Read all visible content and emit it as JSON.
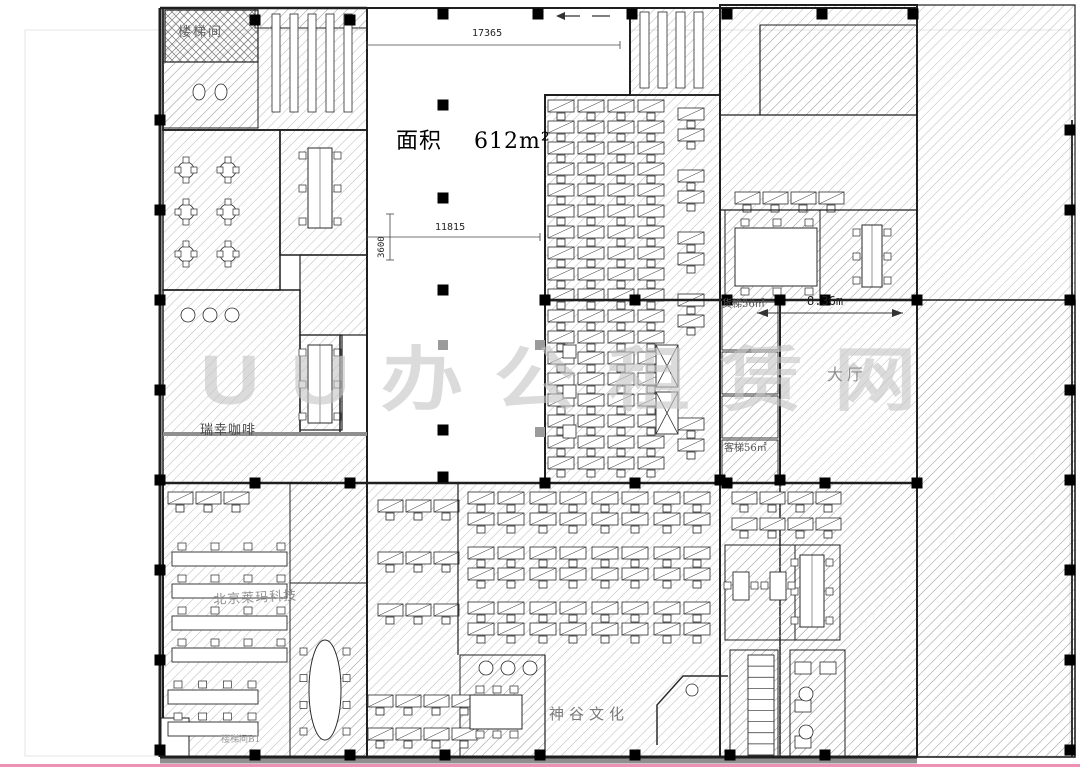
{
  "page": {
    "bg": "#ffffff",
    "frame_color": "#e4e4e4",
    "bottom_line_color": "#ee91b4"
  },
  "plan": {
    "labels": {
      "area": {
        "text": "面积    612m²"
      },
      "stair_tl": {
        "text": "楼梯间"
      },
      "luckin": {
        "text": "瑞幸咖啡"
      },
      "company": {
        "text": "北京莱玛科技"
      },
      "stair_b1": {
        "text": "楼梯间B1"
      },
      "shengu": {
        "text": "神谷文化"
      },
      "lobby": {
        "text": "大厅"
      },
      "freight": {
        "text": "货梯56㎡"
      },
      "passenger": {
        "text": "客梯56㎡"
      }
    },
    "dims": {
      "top": {
        "text": "17365"
      },
      "mid": {
        "text": "11815"
      },
      "left": {
        "text": "3600"
      },
      "lobby_width": {
        "text": "8.36m"
      }
    },
    "watermark": {
      "text": "UU办公租赁网"
    },
    "colors": {
      "hatch": "#9a9a9a",
      "wall": "#1f1f1f",
      "gray_wall": "#8f8f8f",
      "furniture": "#2a2a2a"
    },
    "geometry": {
      "rooms": [
        [
          255,
          8,
          112,
          20,
          "h",
          1
        ],
        [
          163,
          8,
          204,
          122,
          "h",
          1.8
        ],
        [
          165,
          10,
          93,
          52,
          "x",
          1.2
        ],
        [
          163,
          62,
          95,
          66,
          "h",
          1
        ],
        [
          163,
          130,
          117,
          160,
          "h",
          1.5
        ],
        [
          280,
          130,
          87,
          125,
          "h",
          1.5
        ],
        [
          163,
          290,
          137,
          143,
          "h",
          1.5
        ],
        [
          300,
          255,
          67,
          80,
          "h",
          1.2
        ],
        [
          300,
          335,
          42,
          95,
          "h",
          1.2
        ],
        [
          163,
          433,
          204,
          50,
          "h",
          1.5
        ],
        [
          163,
          483,
          204,
          274,
          "h",
          2
        ],
        [
          290,
          483,
          77,
          100,
          "h",
          1
        ],
        [
          290,
          583,
          77,
          174,
          "h",
          1
        ],
        [
          630,
          8,
          90,
          87,
          "h",
          1.5
        ],
        [
          545,
          95,
          175,
          388,
          "h",
          1.8
        ],
        [
          720,
          5,
          197,
          295,
          "h",
          2
        ],
        [
          760,
          25,
          157,
          90,
          "h",
          1
        ],
        [
          725,
          210,
          95,
          90,
          "h",
          1
        ],
        [
          820,
          210,
          97,
          90,
          "h",
          1
        ],
        [
          917,
          5,
          158,
          752,
          "h",
          1.2
        ],
        [
          780,
          300,
          295,
          457,
          "h",
          1.5
        ],
        [
          720,
          300,
          60,
          183,
          "h",
          1.5
        ],
        [
          722,
          302,
          56,
          48,
          "h",
          0.9
        ],
        [
          722,
          352,
          56,
          42,
          "h",
          0.9
        ],
        [
          722,
          396,
          56,
          42,
          "h",
          0.9
        ],
        [
          722,
          440,
          56,
          43,
          "h",
          0.9
        ],
        [
          367,
          483,
          353,
          274,
          "h",
          1.8
        ],
        [
          720,
          483,
          197,
          274,
          "h",
          1.8
        ],
        [
          460,
          655,
          85,
          102,
          "h",
          1
        ],
        [
          725,
          545,
          70,
          95,
          "h",
          1
        ],
        [
          795,
          545,
          45,
          95,
          "h",
          1
        ],
        [
          730,
          650,
          48,
          107,
          "h",
          1
        ],
        [
          790,
          650,
          55,
          107,
          "h",
          1
        ],
        [
          161,
          718,
          28,
          39,
          "w",
          1
        ]
      ],
      "atrium_path": "M367,8 L630,8 L630,95 L545,95 L545,483 L367,483 Z",
      "walls": [
        [
          160,
          8,
          160,
          757,
          3
        ],
        [
          160,
          757,
          917,
          757,
          3
        ],
        [
          160,
          8,
          367,
          8,
          2.5
        ],
        [
          630,
          8,
          917,
          8,
          2
        ],
        [
          545,
          300,
          917,
          300,
          2.5
        ],
        [
          160,
          483,
          917,
          483,
          2.5
        ],
        [
          720,
          5,
          720,
          300,
          2
        ],
        [
          720,
          300,
          720,
          483,
          2
        ],
        [
          780,
          300,
          780,
          483,
          2
        ],
        [
          760,
          25,
          760,
          115,
          1.2
        ],
        [
          720,
          115,
          917,
          115,
          1.2
        ],
        [
          720,
          210,
          917,
          210,
          1.2
        ],
        [
          917,
          5,
          917,
          757,
          2
        ],
        [
          1072,
          120,
          1072,
          757,
          1.8
        ],
        [
          458,
          483,
          458,
          655,
          1.2
        ],
        [
          545,
          655,
          545,
          757,
          1.2
        ],
        [
          340,
          335,
          340,
          433,
          1.5
        ]
      ],
      "gray_walls": [
        [
          160,
          761,
          917,
          761,
          5
        ],
        [
          163,
          434,
          367,
          434,
          4
        ]
      ],
      "columns": [
        [
          443,
          14
        ],
        [
          538,
          14
        ],
        [
          632,
          14
        ],
        [
          727,
          14
        ],
        [
          822,
          14
        ],
        [
          913,
          14
        ],
        [
          255,
          20
        ],
        [
          350,
          20
        ],
        [
          443,
          105
        ],
        [
          443,
          198
        ],
        [
          443,
          290
        ],
        [
          443,
          430
        ],
        [
          443,
          477
        ],
        [
          160,
          120
        ],
        [
          160,
          210
        ],
        [
          160,
          300
        ],
        [
          160,
          390
        ],
        [
          160,
          480
        ],
        [
          160,
          570
        ],
        [
          160,
          660
        ],
        [
          160,
          750
        ],
        [
          545,
          300
        ],
        [
          635,
          300
        ],
        [
          727,
          300
        ],
        [
          780,
          300
        ],
        [
          825,
          300
        ],
        [
          917,
          300
        ],
        [
          255,
          483
        ],
        [
          350,
          483
        ],
        [
          545,
          483
        ],
        [
          635,
          483
        ],
        [
          727,
          483
        ],
        [
          825,
          483
        ],
        [
          917,
          483
        ],
        [
          255,
          755
        ],
        [
          350,
          755
        ],
        [
          445,
          755
        ],
        [
          540,
          755
        ],
        [
          635,
          755
        ],
        [
          730,
          755
        ],
        [
          825,
          755
        ],
        [
          1070,
          130
        ],
        [
          1070,
          210
        ],
        [
          1070,
          300
        ],
        [
          1070,
          390
        ],
        [
          1070,
          480
        ],
        [
          1070,
          570
        ],
        [
          1070,
          660
        ],
        [
          1070,
          750
        ],
        [
          720,
          480
        ],
        [
          780,
          480
        ]
      ],
      "gray_columns": [
        [
          443,
          345
        ],
        [
          540,
          345
        ],
        [
          540,
          432
        ]
      ],
      "pods3": [
        [
          548,
          100
        ],
        [
          608,
          100
        ],
        [
          548,
          163
        ],
        [
          608,
          163
        ],
        [
          548,
          226
        ],
        [
          608,
          226
        ],
        [
          548,
          289
        ],
        [
          608,
          289
        ],
        [
          548,
          352
        ],
        [
          608,
          352
        ],
        [
          548,
          415
        ],
        [
          608,
          415
        ]
      ],
      "pods2": [
        [
          468,
          492
        ],
        [
          530,
          492
        ],
        [
          592,
          492
        ],
        [
          654,
          492
        ],
        [
          468,
          547
        ],
        [
          530,
          547
        ],
        [
          592,
          547
        ],
        [
          654,
          547
        ],
        [
          468,
          602
        ],
        [
          530,
          602
        ],
        [
          592,
          602
        ],
        [
          654,
          602
        ]
      ],
      "pods1": [
        [
          678,
          108
        ],
        [
          678,
          170
        ],
        [
          678,
          232
        ],
        [
          678,
          294
        ],
        [
          678,
          418
        ]
      ],
      "rowdesks": [
        [
          378,
          500,
          3
        ],
        [
          378,
          552,
          3
        ],
        [
          378,
          604,
          3
        ],
        [
          368,
          695,
          4
        ],
        [
          368,
          728,
          4
        ],
        [
          732,
          492,
          4
        ],
        [
          732,
          518,
          4
        ],
        [
          168,
          492,
          3
        ],
        [
          735,
          192,
          4
        ]
      ],
      "roundtables": [
        [
          186,
          170
        ],
        [
          228,
          170
        ],
        [
          186,
          212
        ],
        [
          228,
          212
        ],
        [
          186,
          254
        ],
        [
          228,
          254
        ]
      ],
      "vbars": [
        [
          272,
          14,
          8,
          98
        ],
        [
          290,
          14,
          8,
          98
        ],
        [
          308,
          14,
          8,
          98
        ],
        [
          326,
          14,
          8,
          98
        ],
        [
          344,
          14,
          8,
          98
        ],
        [
          640,
          12,
          9,
          76
        ],
        [
          658,
          12,
          9,
          76
        ],
        [
          676,
          12,
          9,
          76
        ],
        [
          694,
          12,
          9,
          76
        ]
      ],
      "vbenches": [
        [
          308,
          148,
          24,
          80
        ],
        [
          308,
          345,
          24,
          78
        ],
        [
          862,
          225,
          20,
          62
        ],
        [
          800,
          555,
          24,
          72
        ]
      ],
      "hbenches": [
        [
          172,
          552,
          115,
          14
        ],
        [
          172,
          584,
          115,
          14
        ],
        [
          172,
          616,
          115,
          14
        ],
        [
          172,
          648,
          115,
          14
        ],
        [
          168,
          690,
          90,
          14
        ],
        [
          168,
          722,
          90,
          14
        ]
      ],
      "ctables": [
        [
          735,
          228,
          82,
          58
        ],
        [
          470,
          695,
          52,
          34
        ]
      ],
      "stables": [
        [
          733,
          572,
          16,
          28
        ],
        [
          770,
          572,
          16,
          28
        ]
      ],
      "ovals": [
        [
          325,
          690,
          16,
          50
        ]
      ],
      "xbraces": [
        [
          656,
          345,
          22,
          42
        ],
        [
          656,
          392,
          22,
          42
        ]
      ],
      "ladders": [
        [
          748,
          655,
          26,
          100,
          9
        ]
      ],
      "fixrects": [
        [
          563,
          345,
          13,
          13
        ],
        [
          563,
          385,
          13,
          13
        ],
        [
          563,
          425,
          13,
          13
        ],
        [
          795,
          662,
          16,
          12
        ],
        [
          795,
          700,
          16,
          12
        ],
        [
          795,
          736,
          16,
          12
        ],
        [
          820,
          662,
          16,
          12
        ]
      ],
      "circles": [
        [
          188,
          315,
          7
        ],
        [
          210,
          315,
          7
        ],
        [
          232,
          315,
          7
        ],
        [
          486,
          668,
          7
        ],
        [
          508,
          668,
          7
        ],
        [
          530,
          668,
          7
        ],
        [
          692,
          690,
          6
        ],
        [
          806,
          694,
          7
        ],
        [
          806,
          732,
          7
        ]
      ],
      "ellipses": [
        [
          199,
          92,
          6,
          8
        ],
        [
          221,
          92,
          6,
          8
        ]
      ],
      "paths": [
        [
          "M657,745 L657,705 L683,676 L728,676",
          1.5
        ]
      ],
      "north_lines": [
        [
          562,
          16,
          580,
          16
        ],
        [
          592,
          16,
          610,
          16
        ]
      ],
      "north_poly": "556,16 565,12 565,20",
      "dim_lines": [
        [
          367,
          45,
          620,
          45
        ],
        [
          367,
          237,
          540,
          237
        ],
        [
          390,
          214,
          390,
          260
        ]
      ],
      "arrow_line": [
        757,
        313,
        903,
        313
      ],
      "page_frame": [
        25,
        30,
        1045,
        726
      ]
    }
  }
}
